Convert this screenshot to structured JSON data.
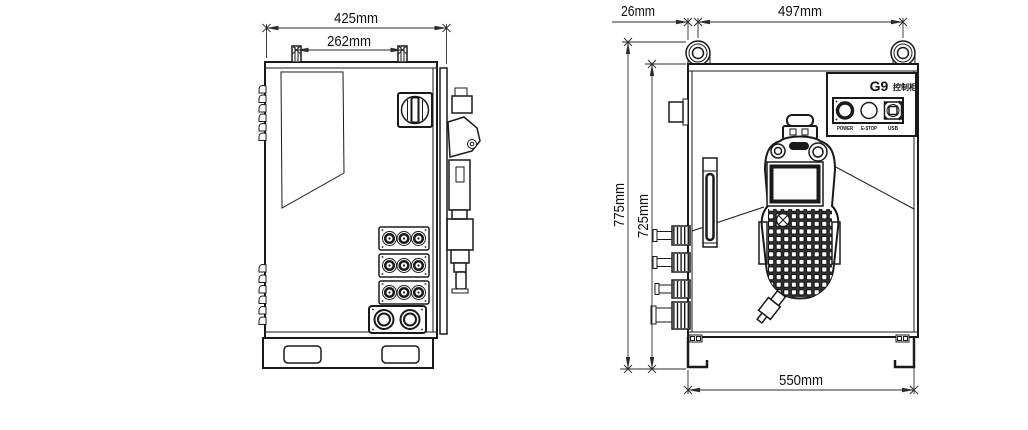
{
  "drawing": {
    "kind": "control cabinet dimension drawing",
    "colors": {
      "line": "#1a1a1a",
      "background": "#ffffff"
    }
  },
  "side_view": {
    "dims": {
      "overall_width": "425mm",
      "lug_spacing": "262mm"
    }
  },
  "front_view": {
    "dims": {
      "ring_offset": "26mm",
      "ring_spacing": "497mm",
      "overall_height": "775mm",
      "body_height": "725mm",
      "body_width": "550mm"
    },
    "panel": {
      "model": "G9",
      "model_label": "控制柜",
      "controls": [
        {
          "label": "POWER"
        },
        {
          "label": "E-STOP"
        },
        {
          "label": "USB"
        }
      ]
    }
  }
}
